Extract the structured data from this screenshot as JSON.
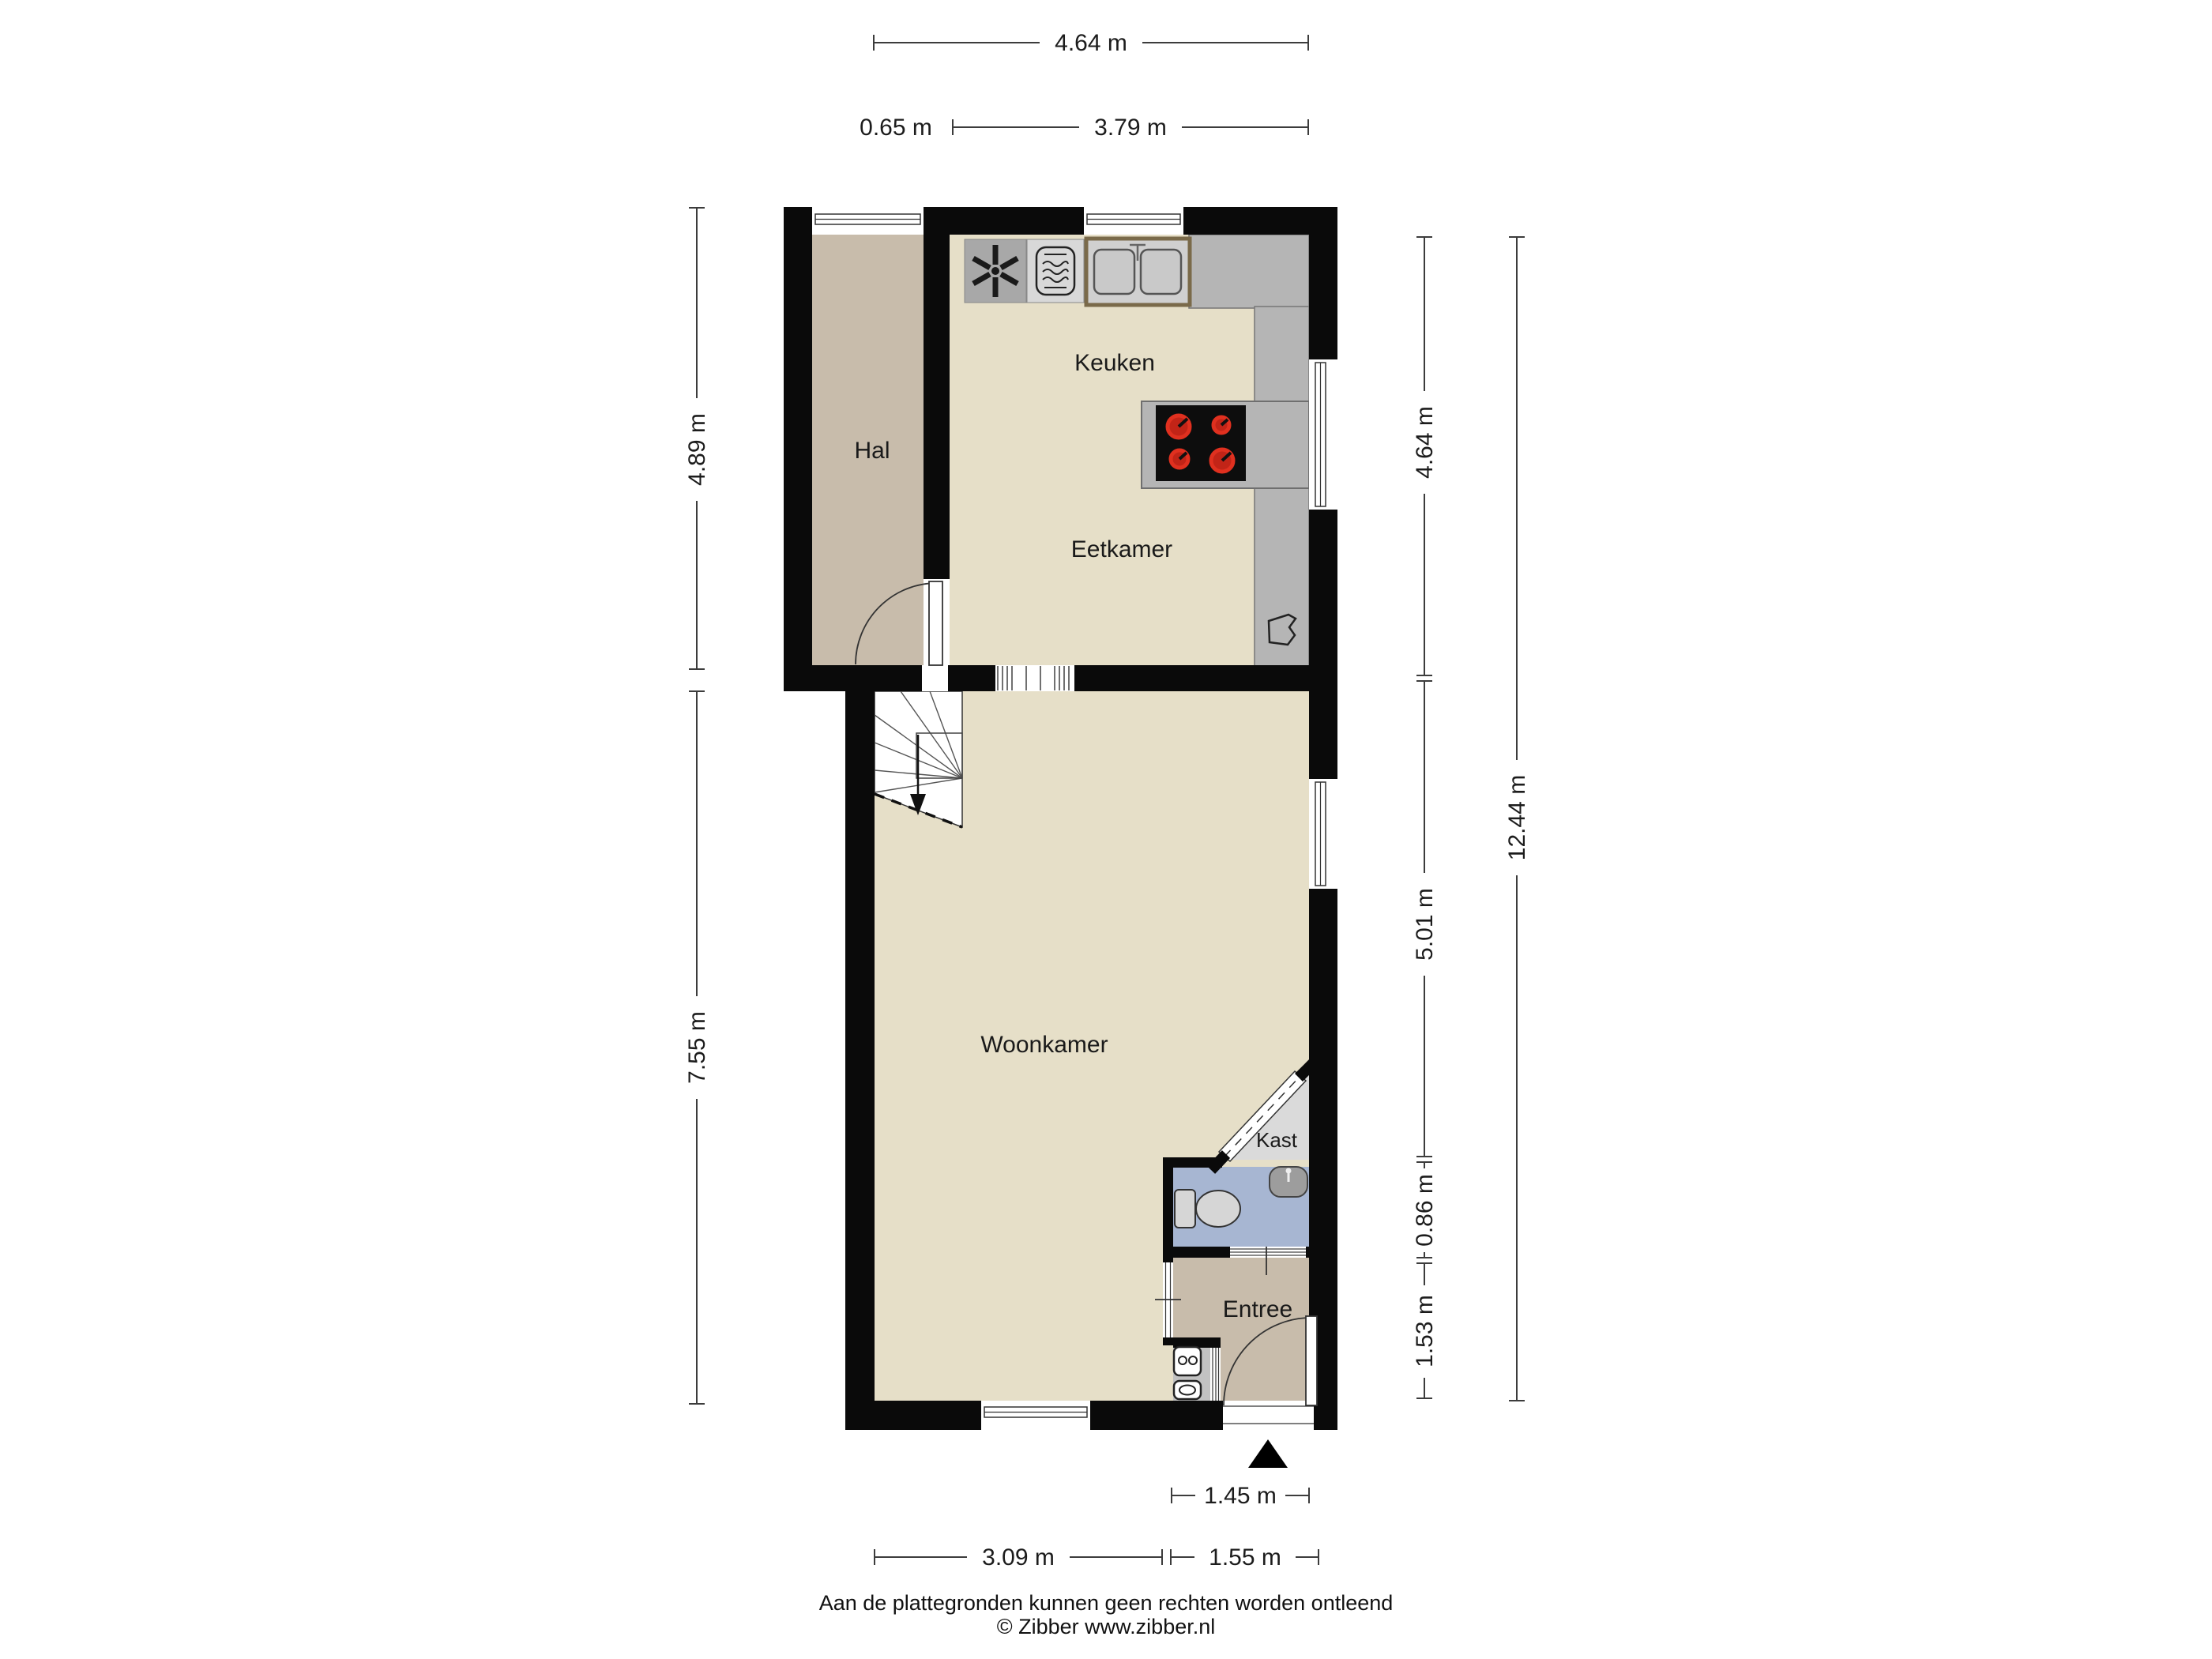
{
  "plan_title": "floorplan",
  "rooms": {
    "hal": "Hal",
    "keuken": "Keuken",
    "eetkamer": "Eetkamer",
    "woonkamer": "Woonkamer",
    "kast": "Kast",
    "entree": "Entree"
  },
  "dimensions": {
    "top_total": "4.64 m",
    "top_hal": "0.65 m",
    "top_keuken": "3.79 m",
    "left_hal": "4.89 m",
    "left_woonkamer": "7.55 m",
    "right_keuken": "4.64 m",
    "right_woonkamer": "5.01 m",
    "right_toilet": "0.86 m",
    "right_entree": "1.53 m",
    "right_total": "12.44 m",
    "bottom_door": "1.45 m",
    "bottom_woonkamer": "3.09 m",
    "bottom_entree": "1.55 m"
  },
  "footer": {
    "disclaimer": "Aan de plattegronden kunnen geen rechten worden ontleend",
    "copyright": "© Zibber www.zibber.nl"
  },
  "icons": {
    "extractor_fan": "fan-icon",
    "microwave": "microwave-icon",
    "kitchen_sink": "double-sink-icon",
    "cooktop": "stove-icon",
    "toilet": "toilet-icon",
    "washbasin": "washbasin-icon",
    "boiler_units": "boiler-icon",
    "stairs": "stairs-icon",
    "entrance_marker": "entrance-triangle-icon"
  },
  "colors": {
    "wall": "#0a0a0a",
    "floor": "#e6dfc8",
    "floor_secondary": "#c8bcab",
    "counter": "#b5b5b5",
    "fan_square": "#a8a8a8",
    "microwave_square": "#d8d8d8",
    "toilet_floor": "#a7b6d2",
    "closet_floor": "#dadada",
    "cupboard_floor": "#c2c2c2",
    "burner": "#e0301f",
    "stove": "#0d0d0d"
  }
}
